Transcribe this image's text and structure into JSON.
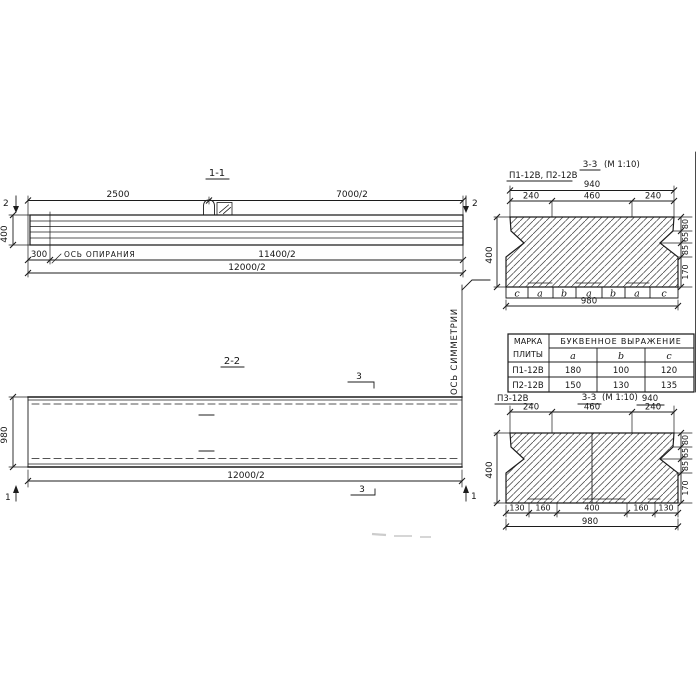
{
  "colors": {
    "ink": "#1c1c1c",
    "paper": "#ffffff"
  },
  "sections": {
    "s11": {
      "title": "1-1",
      "dim_top_left": "2500",
      "dim_top_right": "7000/2",
      "cut_left": "2",
      "cut_right": "2",
      "height": "400",
      "dim_300": "300",
      "axis_label": "ОСЬ ОПИРАНИЯ",
      "dim_mid": "11400/2",
      "dim_bottom": "12000/2"
    },
    "s22": {
      "title": "2-2",
      "cut_top": "3",
      "cut_bottom": "3",
      "cut_left": "1",
      "cut_right": "1",
      "height": "980",
      "dim_bottom": "12000/2"
    },
    "s33a": {
      "label": "П1-12В, П2-12В",
      "title_num": "3-3",
      "title_scale": "(М 1:10)",
      "dim_940": "940",
      "dims_top": [
        "240",
        "460",
        "240"
      ],
      "height": "400",
      "dims_right": [
        "80",
        "65",
        "85",
        "170"
      ],
      "letters": [
        "c",
        "a",
        "b",
        "a",
        "b",
        "a",
        "c"
      ],
      "dim_980": "980"
    },
    "s33b": {
      "label": "П3-12В",
      "title_num": "3-3",
      "title_scale": "(М 1:10)",
      "dim_940": "940",
      "dims_top": [
        "240",
        "460",
        "240"
      ],
      "height": "400",
      "dims_right": [
        "80",
        "65",
        "85",
        "170"
      ],
      "dims_bottom": [
        "130",
        "160",
        "400",
        "160",
        "130"
      ],
      "dim_980": "980"
    },
    "symmetry": "ОСЬ СИММЕТРИИ"
  },
  "table": {
    "col1_line1": "МАРКА",
    "col1_line2": "ПЛИТЫ",
    "group": "БУКВЕННОЕ ВЫРАЖЕНИЕ",
    "cols": [
      "a",
      "b",
      "c"
    ],
    "rows": [
      [
        "П1-12В",
        "180",
        "100",
        "120"
      ],
      [
        "П2-12В",
        "150",
        "130",
        "135"
      ]
    ]
  }
}
